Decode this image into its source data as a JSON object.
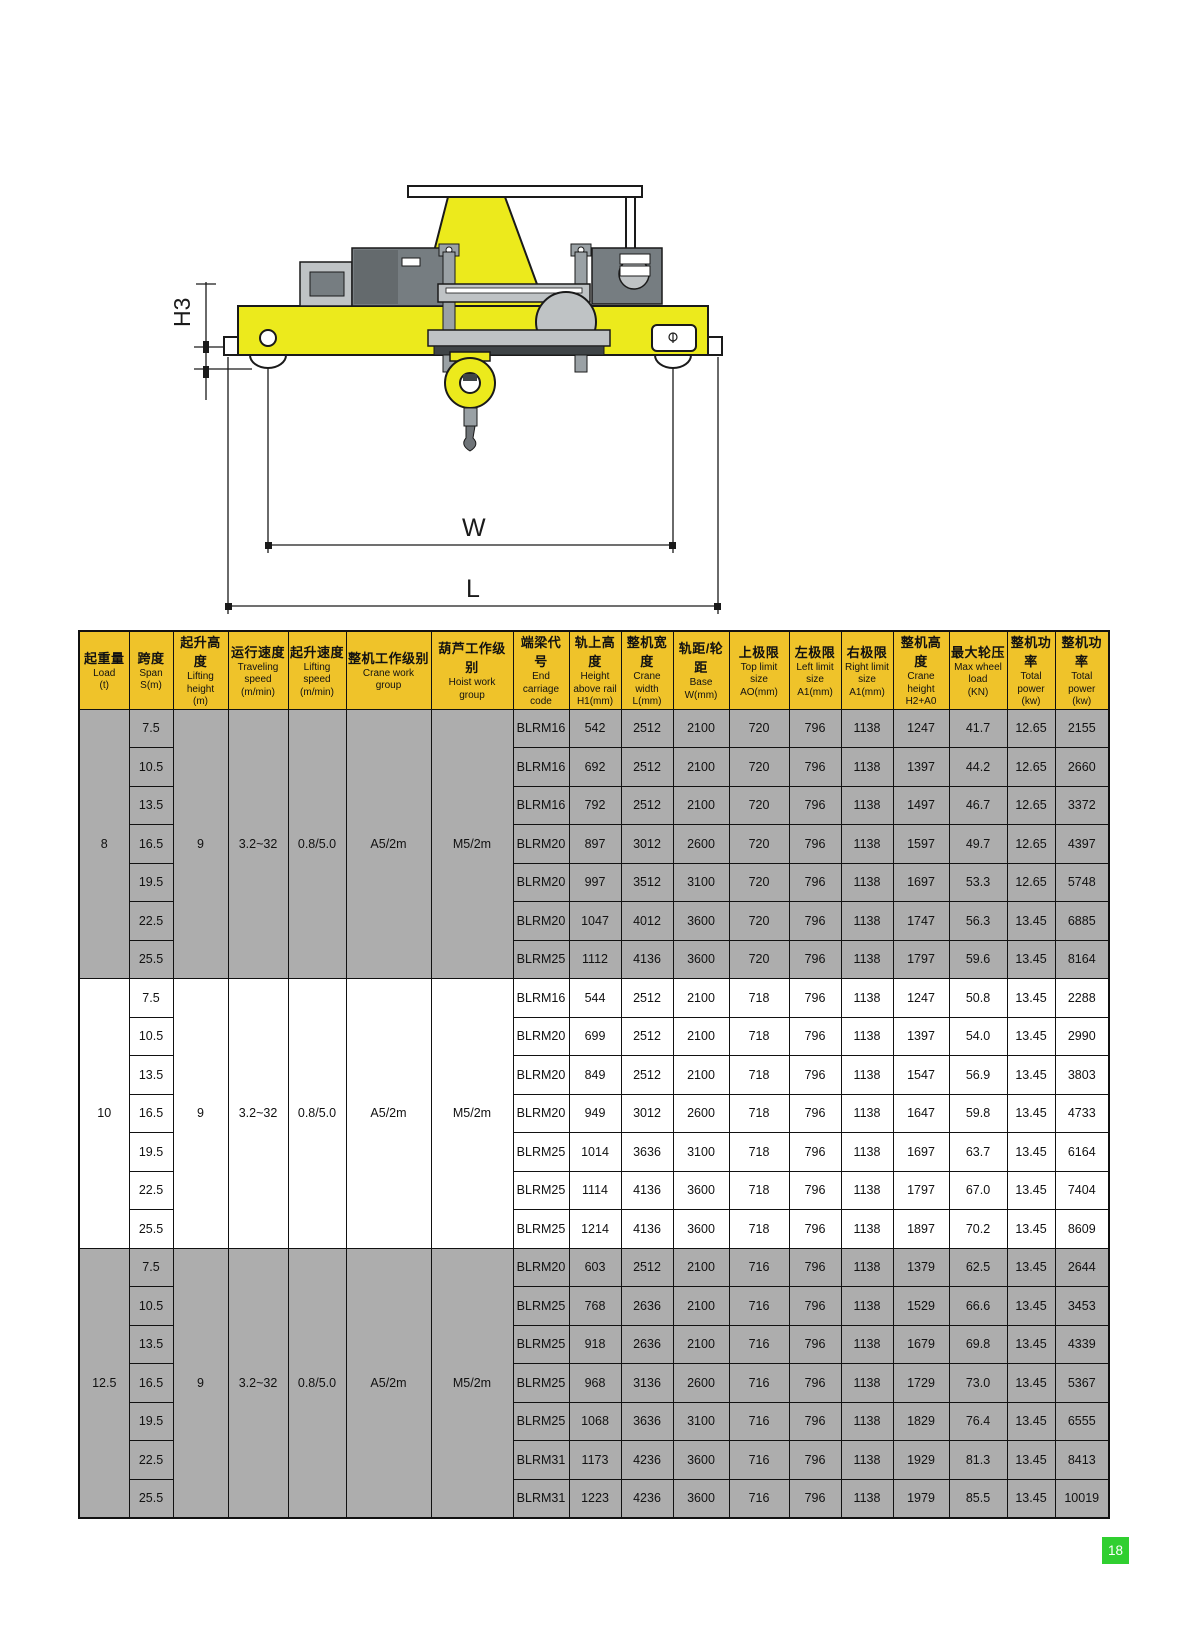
{
  "page": {
    "number": "18"
  },
  "colors": {
    "header_yellow": "#efc32a",
    "row_gray": "#adadad",
    "row_white": "#ffffff",
    "crane_yellow": "#ecea1c",
    "machinery_dark": "#767d81",
    "machinery_mid": "#9aa1a5",
    "machinery_light": "#bfc3c5",
    "page_green": "#30cf30",
    "border_black": "#1a1a1a"
  },
  "diagram": {
    "labels": {
      "h3": "H3",
      "w": "W",
      "l": "L"
    }
  },
  "table": {
    "header": [
      {
        "cn": "起重量",
        "en": "Load\n(t)"
      },
      {
        "cn": "跨度",
        "en": "Span\nS(m)"
      },
      {
        "cn": "起升高度",
        "en": "Lifting\nheight\n(m)"
      },
      {
        "cn": "运行速度",
        "en": "Traveling\nspeed\n(m/min)"
      },
      {
        "cn": "起升速度",
        "en": "Lifting\nspeed\n(m/min)"
      },
      {
        "cn": "整机工作级别",
        "en": "Crane work\ngroup"
      },
      {
        "cn": "葫芦工作级别",
        "en": "Hoist work\ngroup"
      },
      {
        "cn": "端梁代号",
        "en": "End\ncarriage\ncode"
      },
      {
        "cn": "轨上高度",
        "en": "Height\nabove rail\nH1(mm)"
      },
      {
        "cn": "整机宽度",
        "en": "Crane\nwidth\nL(mm)"
      },
      {
        "cn": "轨距/轮距",
        "en": "Base\nW(mm)"
      },
      {
        "cn": "上极限",
        "en": "Top limit\nsize\nAO(mm)"
      },
      {
        "cn": "左极限",
        "en": "Left limit\nsize\nA1(mm)"
      },
      {
        "cn": "右极限",
        "en": "Right limit\nsize\nA1(mm)"
      },
      {
        "cn": "整机高度",
        "en": "Crane\nheight\nH2+A0"
      },
      {
        "cn": "最大轮压",
        "en": "Max wheel\nload\n(KN)"
      },
      {
        "cn": "整机功率",
        "en": "Total\npower\n(kw)"
      },
      {
        "cn": "整机功率",
        "en": "Total\npower\n(kw)"
      }
    ],
    "groups": [
      {
        "load": "8",
        "shaded": true,
        "lifting_height": "9",
        "traveling_speed": "3.2~32",
        "lifting_speed": "0.8/5.0",
        "crane_work_group": "A5/2m",
        "hoist_work_group": "M5/2m",
        "rows": [
          {
            "span": "7.5",
            "values": [
              "BLRM16",
              "542",
              "2512",
              "2100",
              "720",
              "796",
              "1138",
              "1247",
              "41.7",
              "12.65",
              "2155"
            ]
          },
          {
            "span": "10.5",
            "values": [
              "BLRM16",
              "692",
              "2512",
              "2100",
              "720",
              "796",
              "1138",
              "1397",
              "44.2",
              "12.65",
              "2660"
            ]
          },
          {
            "span": "13.5",
            "values": [
              "BLRM16",
              "792",
              "2512",
              "2100",
              "720",
              "796",
              "1138",
              "1497",
              "46.7",
              "12.65",
              "3372"
            ]
          },
          {
            "span": "16.5",
            "values": [
              "BLRM20",
              "897",
              "3012",
              "2600",
              "720",
              "796",
              "1138",
              "1597",
              "49.7",
              "12.65",
              "4397"
            ]
          },
          {
            "span": "19.5",
            "values": [
              "BLRM20",
              "997",
              "3512",
              "3100",
              "720",
              "796",
              "1138",
              "1697",
              "53.3",
              "12.65",
              "5748"
            ]
          },
          {
            "span": "22.5",
            "values": [
              "BLRM20",
              "1047",
              "4012",
              "3600",
              "720",
              "796",
              "1138",
              "1747",
              "56.3",
              "13.45",
              "6885"
            ]
          },
          {
            "span": "25.5",
            "values": [
              "BLRM25",
              "1112",
              "4136",
              "3600",
              "720",
              "796",
              "1138",
              "1797",
              "59.6",
              "13.45",
              "8164"
            ]
          }
        ]
      },
      {
        "load": "10",
        "shaded": false,
        "lifting_height": "9",
        "traveling_speed": "3.2~32",
        "lifting_speed": "0.8/5.0",
        "crane_work_group": "A5/2m",
        "hoist_work_group": "M5/2m",
        "rows": [
          {
            "span": "7.5",
            "values": [
              "BLRM16",
              "544",
              "2512",
              "2100",
              "718",
              "796",
              "1138",
              "1247",
              "50.8",
              "13.45",
              "2288"
            ]
          },
          {
            "span": "10.5",
            "values": [
              "BLRM20",
              "699",
              "2512",
              "2100",
              "718",
              "796",
              "1138",
              "1397",
              "54.0",
              "13.45",
              "2990"
            ]
          },
          {
            "span": "13.5",
            "values": [
              "BLRM20",
              "849",
              "2512",
              "2100",
              "718",
              "796",
              "1138",
              "1547",
              "56.9",
              "13.45",
              "3803"
            ]
          },
          {
            "span": "16.5",
            "values": [
              "BLRM20",
              "949",
              "3012",
              "2600",
              "718",
              "796",
              "1138",
              "1647",
              "59.8",
              "13.45",
              "4733"
            ]
          },
          {
            "span": "19.5",
            "values": [
              "BLRM25",
              "1014",
              "3636",
              "3100",
              "718",
              "796",
              "1138",
              "1697",
              "63.7",
              "13.45",
              "6164"
            ]
          },
          {
            "span": "22.5",
            "values": [
              "BLRM25",
              "1114",
              "4136",
              "3600",
              "718",
              "796",
              "1138",
              "1797",
              "67.0",
              "13.45",
              "7404"
            ]
          },
          {
            "span": "25.5",
            "values": [
              "BLRM25",
              "1214",
              "4136",
              "3600",
              "718",
              "796",
              "1138",
              "1897",
              "70.2",
              "13.45",
              "8609"
            ]
          }
        ]
      },
      {
        "load": "12.5",
        "shaded": true,
        "lifting_height": "9",
        "traveling_speed": "3.2~32",
        "lifting_speed": "0.8/5.0",
        "crane_work_group": "A5/2m",
        "hoist_work_group": "M5/2m",
        "rows": [
          {
            "span": "7.5",
            "values": [
              "BLRM20",
              "603",
              "2512",
              "2100",
              "716",
              "796",
              "1138",
              "1379",
              "62.5",
              "13.45",
              "2644"
            ]
          },
          {
            "span": "10.5",
            "values": [
              "BLRM25",
              "768",
              "2636",
              "2100",
              "716",
              "796",
              "1138",
              "1529",
              "66.6",
              "13.45",
              "3453"
            ]
          },
          {
            "span": "13.5",
            "values": [
              "BLRM25",
              "918",
              "2636",
              "2100",
              "716",
              "796",
              "1138",
              "1679",
              "69.8",
              "13.45",
              "4339"
            ]
          },
          {
            "span": "16.5",
            "values": [
              "BLRM25",
              "968",
              "3136",
              "2600",
              "716",
              "796",
              "1138",
              "1729",
              "73.0",
              "13.45",
              "5367"
            ]
          },
          {
            "span": "19.5",
            "values": [
              "BLRM25",
              "1068",
              "3636",
              "3100",
              "716",
              "796",
              "1138",
              "1829",
              "76.4",
              "13.45",
              "6555"
            ]
          },
          {
            "span": "22.5",
            "values": [
              "BLRM31",
              "1173",
              "4236",
              "3600",
              "716",
              "796",
              "1138",
              "1929",
              "81.3",
              "13.45",
              "8413"
            ]
          },
          {
            "span": "25.5",
            "values": [
              "BLRM31",
              "1223",
              "4236",
              "3600",
              "716",
              "796",
              "1138",
              "1979",
              "85.5",
              "13.45",
              "10019"
            ]
          }
        ]
      }
    ]
  }
}
